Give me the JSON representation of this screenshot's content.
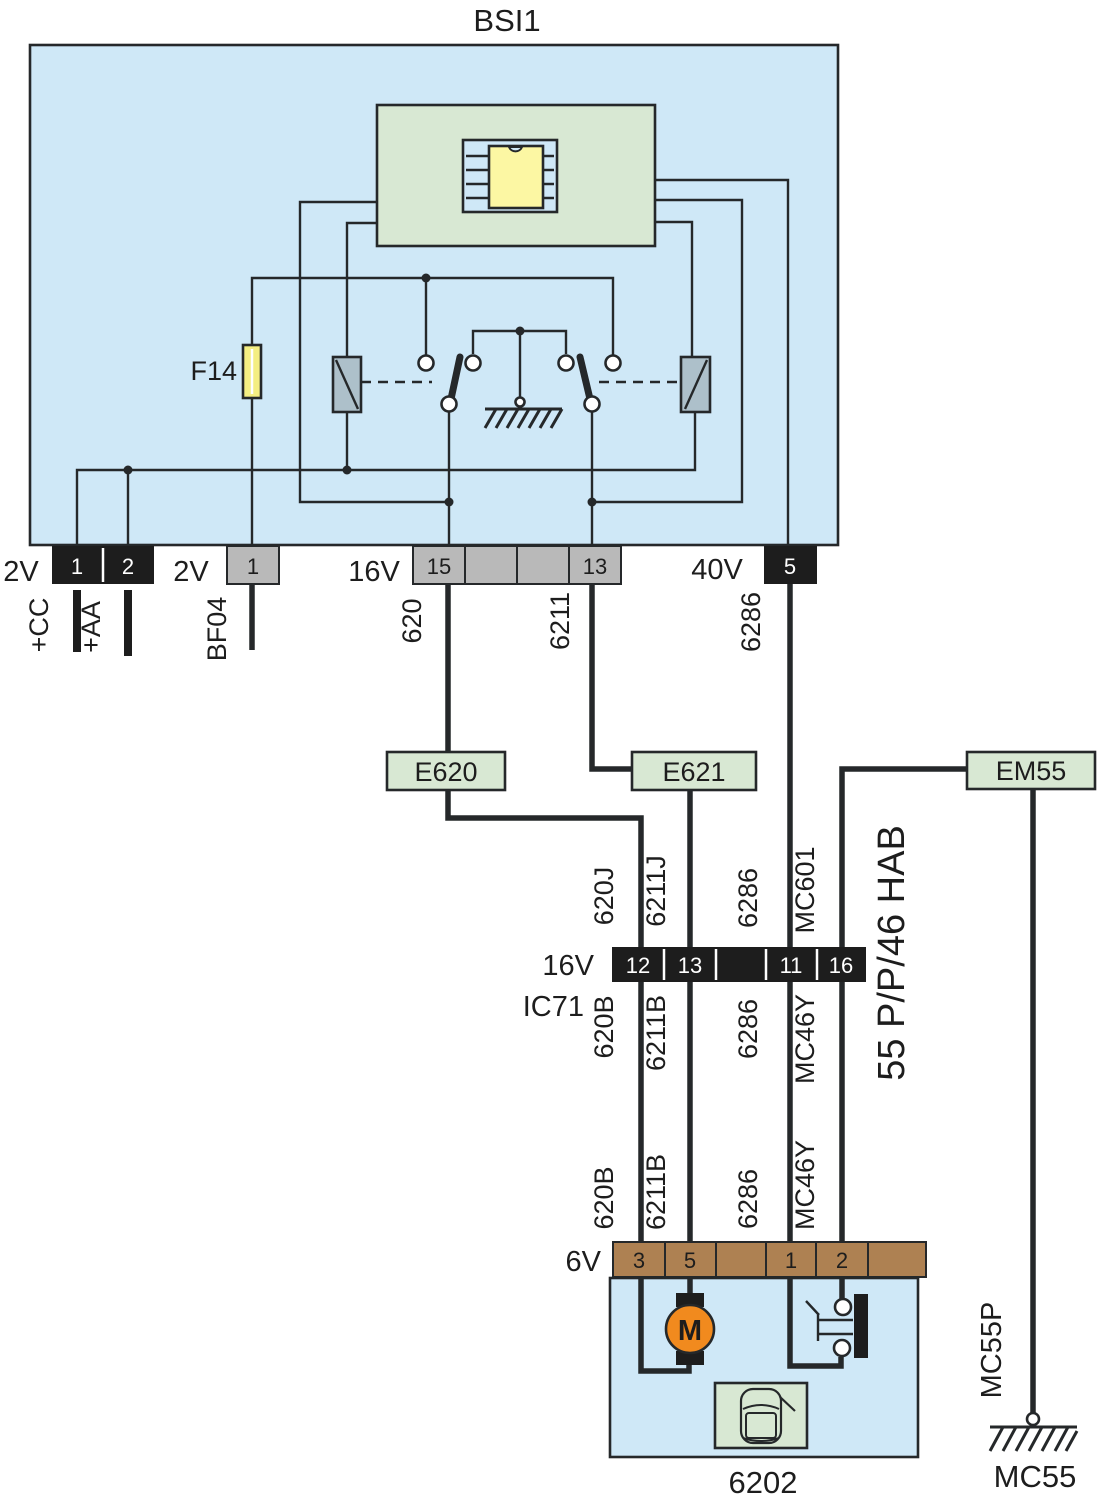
{
  "title": "BSI1",
  "colors": {
    "bsi_fill": "#cfe8f7",
    "module_green": "#d8e8d3",
    "chip_yellow": "#fcf7a3",
    "fuse_yellow": "#f4ee82",
    "relay_fill": "#adc0ca",
    "pin_gray": "#b9b9b9",
    "pin_dark": "#1d1d1d",
    "conn_brown": "#ae8152",
    "motor_orange": "#f18a1e"
  },
  "bsi": {
    "fuse": "F14",
    "conn_2v_left": {
      "label": "2V",
      "pin1": "1",
      "pin2": "2"
    },
    "conn_2v_mid": {
      "label": "2V",
      "pin1": "1"
    },
    "conn_16v": {
      "label": "16V",
      "pin15": "15",
      "pin13": "13"
    },
    "conn_40v": {
      "label": "40V",
      "pin5": "5"
    }
  },
  "wires": {
    "cc": "+CC",
    "aa": "+AA",
    "bf04": "BF04",
    "w620": "620",
    "w6211": "6211",
    "w6286": "6286",
    "w620j": "620J",
    "w6211j": "6211J",
    "mc601": "MC601",
    "w620b": "620B",
    "w6211b": "6211B",
    "mc46y": "MC46Y",
    "mc55p": "MC55P",
    "hab": "55 P/P/46 HAB"
  },
  "junctions": {
    "e620": "E620",
    "e621": "E621",
    "em55": "EM55"
  },
  "ic71": {
    "conn": "16V",
    "name": "IC71",
    "pin12": "12",
    "pin13": "13",
    "pin11": "11",
    "pin16": "16"
  },
  "comp6202": {
    "conn": "6V",
    "pin3": "3",
    "pin5": "5",
    "pin1": "1",
    "pin2": "2",
    "id": "6202",
    "motor": "M"
  },
  "grounds": {
    "mc55": "MC55"
  }
}
